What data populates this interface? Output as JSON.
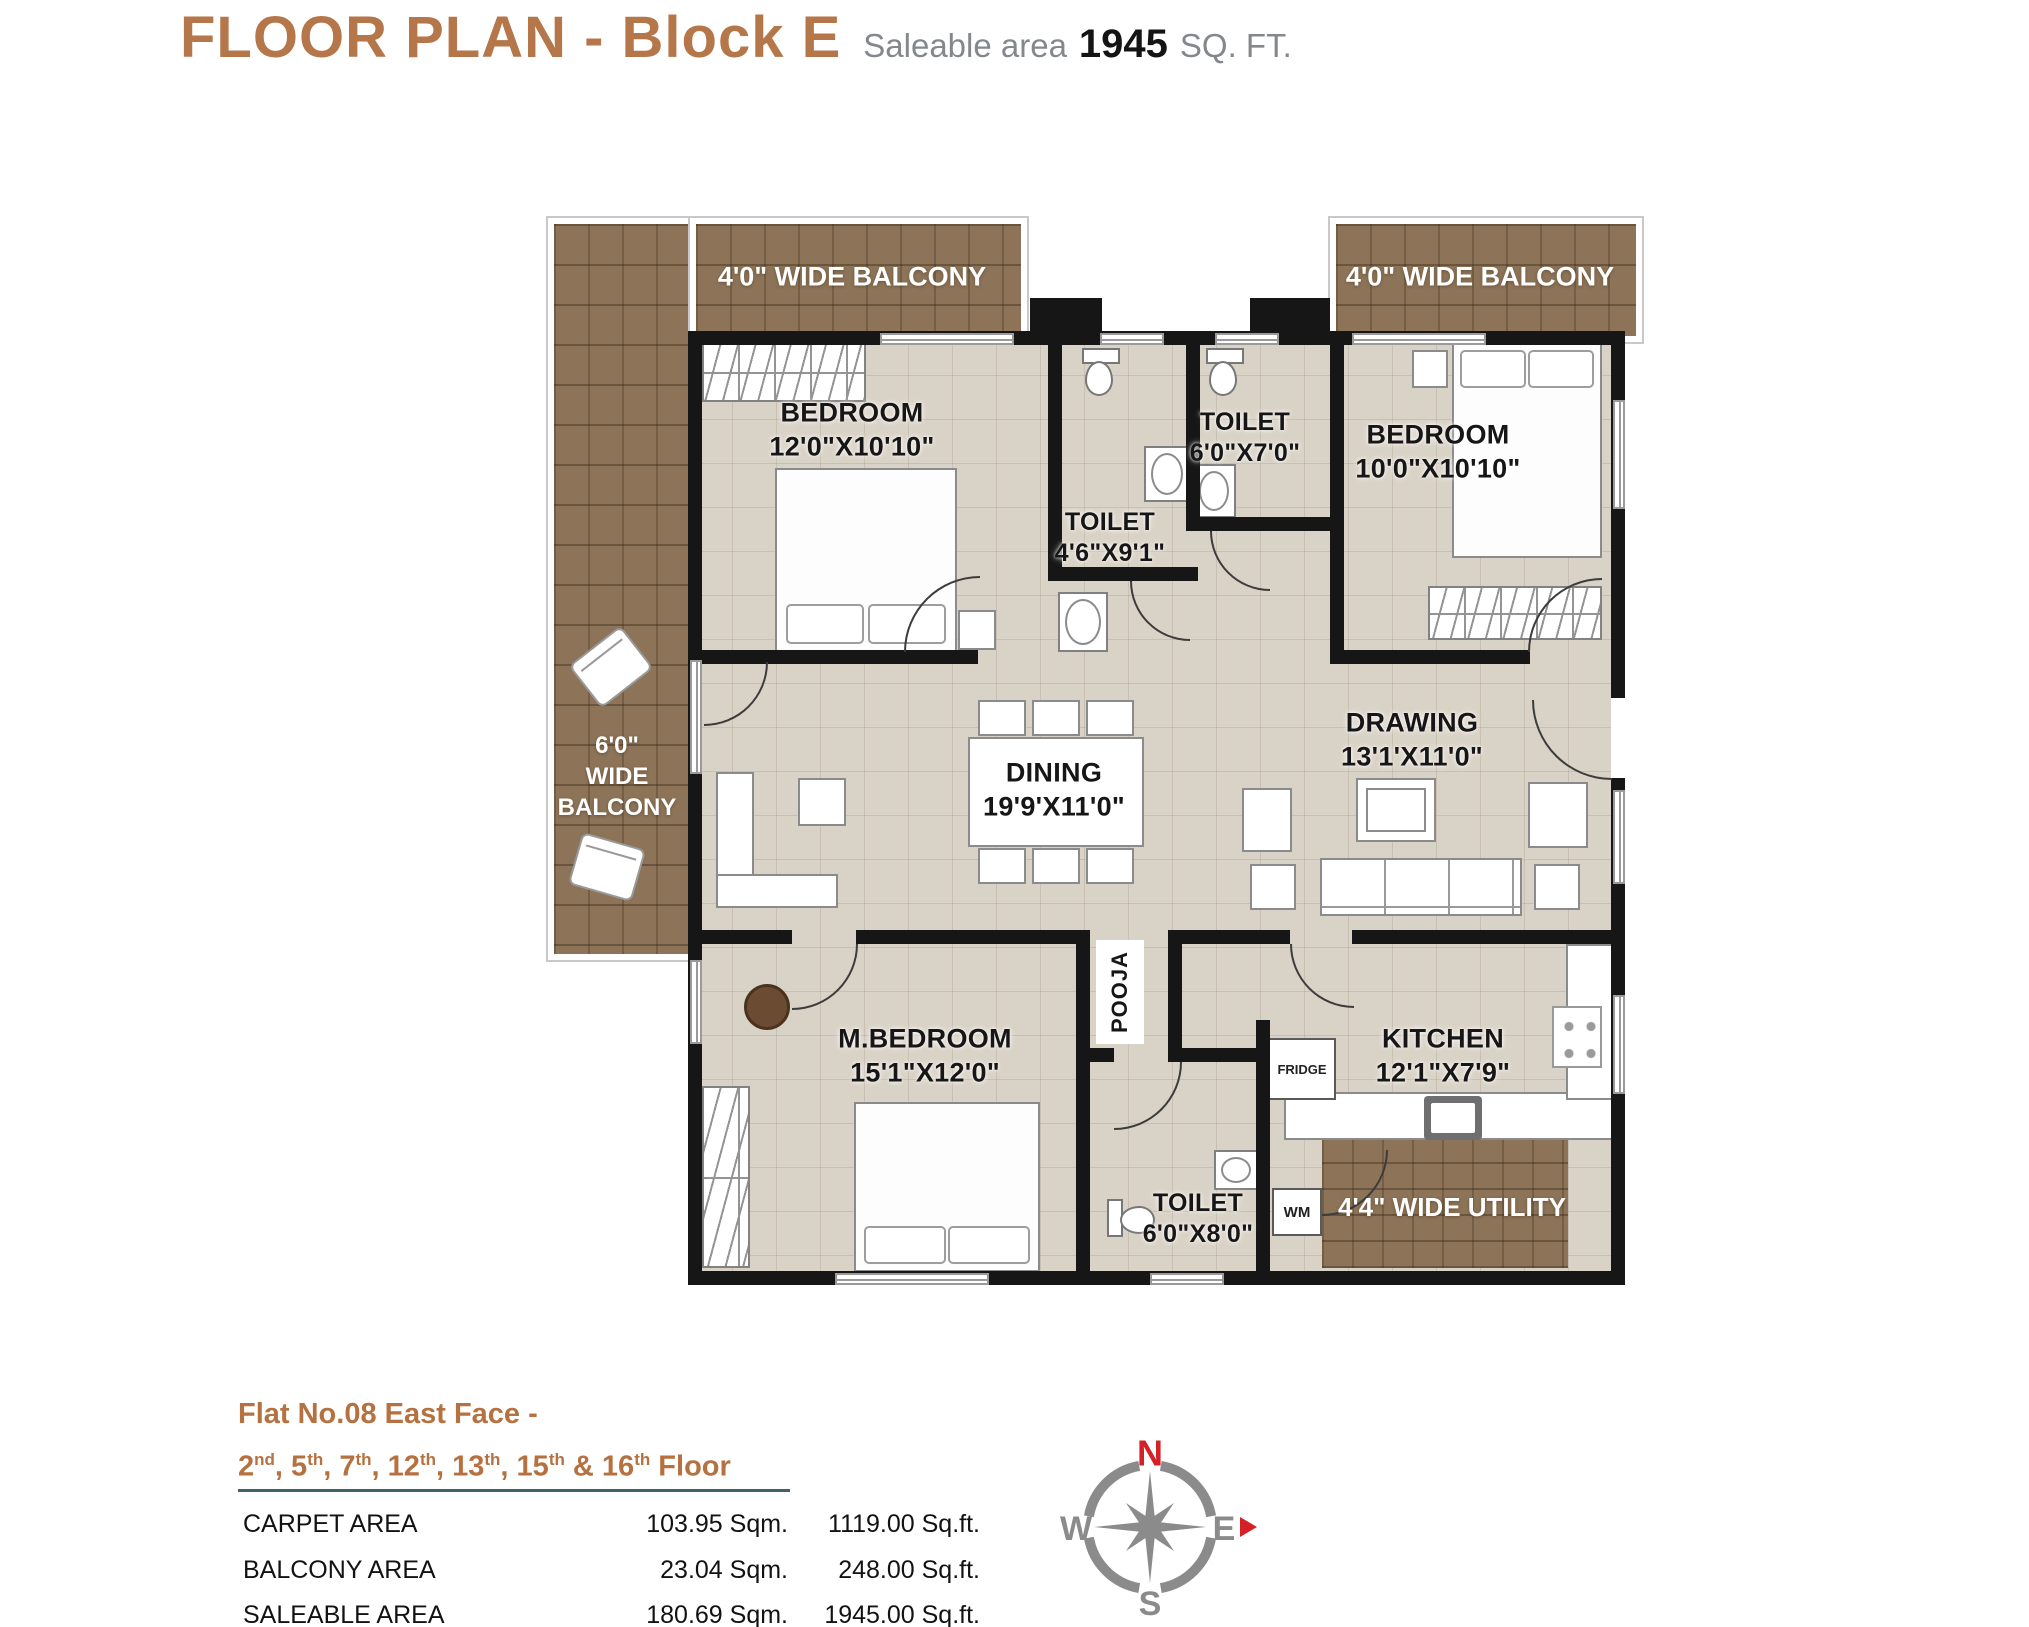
{
  "header": {
    "title": "FLOOR PLAN - Block E",
    "saleable_prefix": "Saleable area",
    "saleable_value": "1945",
    "saleable_suffix": "SQ. FT."
  },
  "plan": {
    "balconies": {
      "top_left": "4'0\" WIDE BALCONY",
      "top_right": "4'0\" WIDE BALCONY",
      "left_line1": "6'0\"",
      "left_line2": "WIDE",
      "left_line3": "BALCONY",
      "utility": "4'4\" WIDE UTILITY"
    },
    "rooms": [
      {
        "name": "BEDROOM",
        "dims": "12'0\"X10'10\""
      },
      {
        "name": "TOILET",
        "dims": "4'6\"X9'1\""
      },
      {
        "name": "TOILET",
        "dims": "6'0\"X7'0\""
      },
      {
        "name": "BEDROOM",
        "dims": "10'0\"X10'10\""
      },
      {
        "name": "DINING",
        "dims": "19'9'X11'0\""
      },
      {
        "name": "DRAWING",
        "dims": "13'1'X11'0\""
      },
      {
        "name": "M.BEDROOM",
        "dims": "15'1\"X12'0\""
      },
      {
        "name": "KITCHEN",
        "dims": "12'1\"X7'9\""
      },
      {
        "name": "TOILET",
        "dims": "6'0\"X8'0\""
      }
    ],
    "labels": {
      "pooja": "POOJA",
      "fridge": "FRIDGE",
      "wm": "WM"
    }
  },
  "compass": {
    "n": "N",
    "e": "E",
    "s": "S",
    "w": "W"
  },
  "footer": {
    "flat_line": "Flat No.08 East Face -",
    "floors": [
      {
        "n": "2",
        "s": "nd"
      },
      {
        "n": "5",
        "s": "th"
      },
      {
        "n": "7",
        "s": "th"
      },
      {
        "n": "12",
        "s": "th"
      },
      {
        "n": "13",
        "s": "th"
      },
      {
        "n": "15",
        "s": "th"
      },
      {
        "n": "16",
        "s": "th"
      }
    ],
    "floors_suffix": "Floor",
    "table": {
      "rows": [
        {
          "label": "CARPET AREA",
          "sqm": "103.95 Sqm.",
          "sqft": "1119.00 Sq.ft."
        },
        {
          "label": "BALCONY AREA",
          "sqm": "23.04 Sqm.",
          "sqft": "248.00 Sq.ft."
        },
        {
          "label": "SALEABLE AREA",
          "sqm": "180.69 Sqm.",
          "sqft": "1945.00 Sq.ft."
        }
      ]
    }
  },
  "colors": {
    "accent_brown": "#b5764a",
    "balcony_brown": "#8d7458",
    "floor_beige": "#d9d2c6",
    "wall_black": "#161616",
    "underline_teal": "#3f616d",
    "compass_gray": "#8b8b8b",
    "compass_red": "#d42027"
  }
}
